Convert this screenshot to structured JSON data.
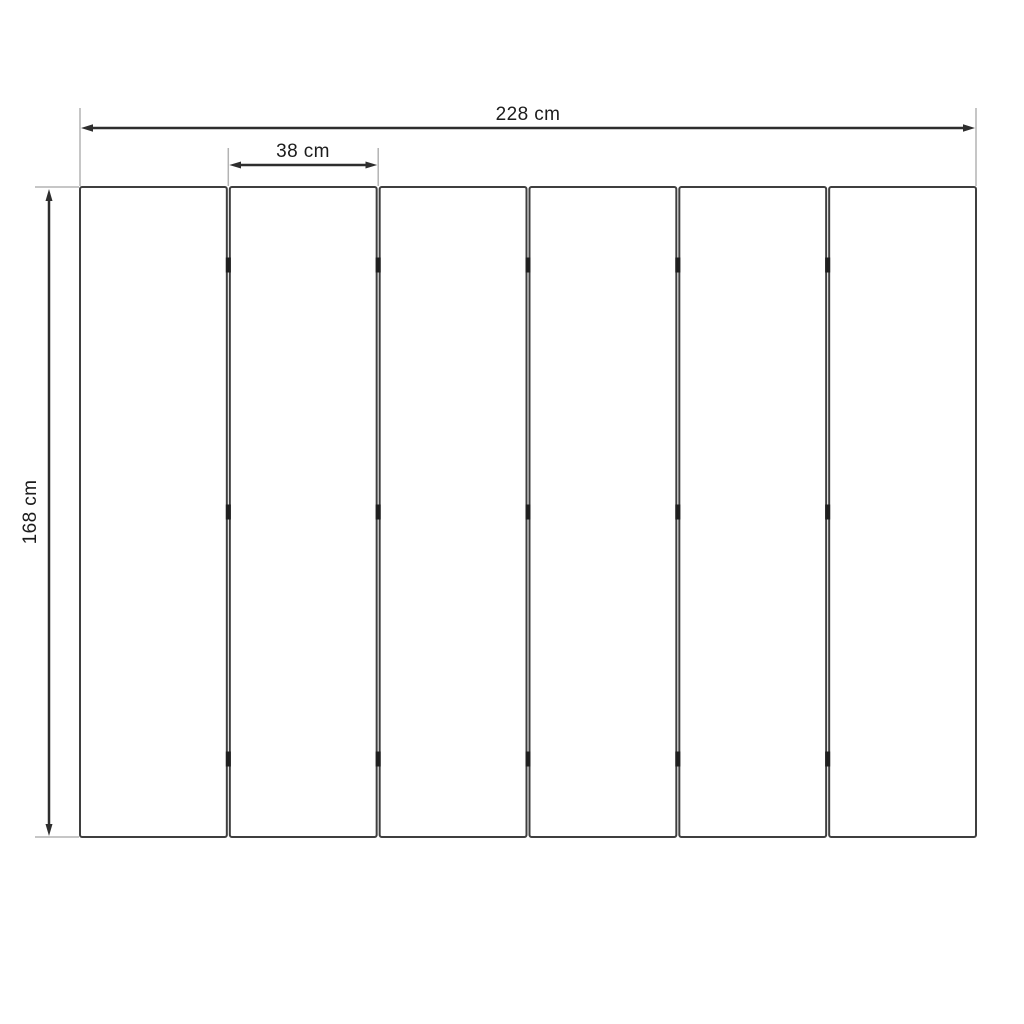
{
  "page": {
    "background": "#ffffff",
    "title": "Six-panel room divider dimension drawing"
  },
  "drawing": {
    "colors": {
      "panel_stroke": "#3f3f3f",
      "panel_fill": "#ffffff",
      "hinge": "#1f1f1f",
      "dimension_line": "#2e2e2e",
      "extension_line": "#b3b3b3",
      "label_text": "#1c1c1c"
    },
    "panels": {
      "count": 6,
      "joint_count": 5,
      "hinge_rows_per_joint": 3
    },
    "dimensions": {
      "total_width": {
        "label": "228 cm",
        "value": 228,
        "unit": "cm",
        "orientation": "horizontal"
      },
      "panel_width": {
        "label": "38 cm",
        "value": 38,
        "unit": "cm",
        "orientation": "horizontal"
      },
      "height": {
        "label": "168 cm",
        "value": 168,
        "unit": "cm",
        "orientation": "vertical"
      }
    }
  }
}
